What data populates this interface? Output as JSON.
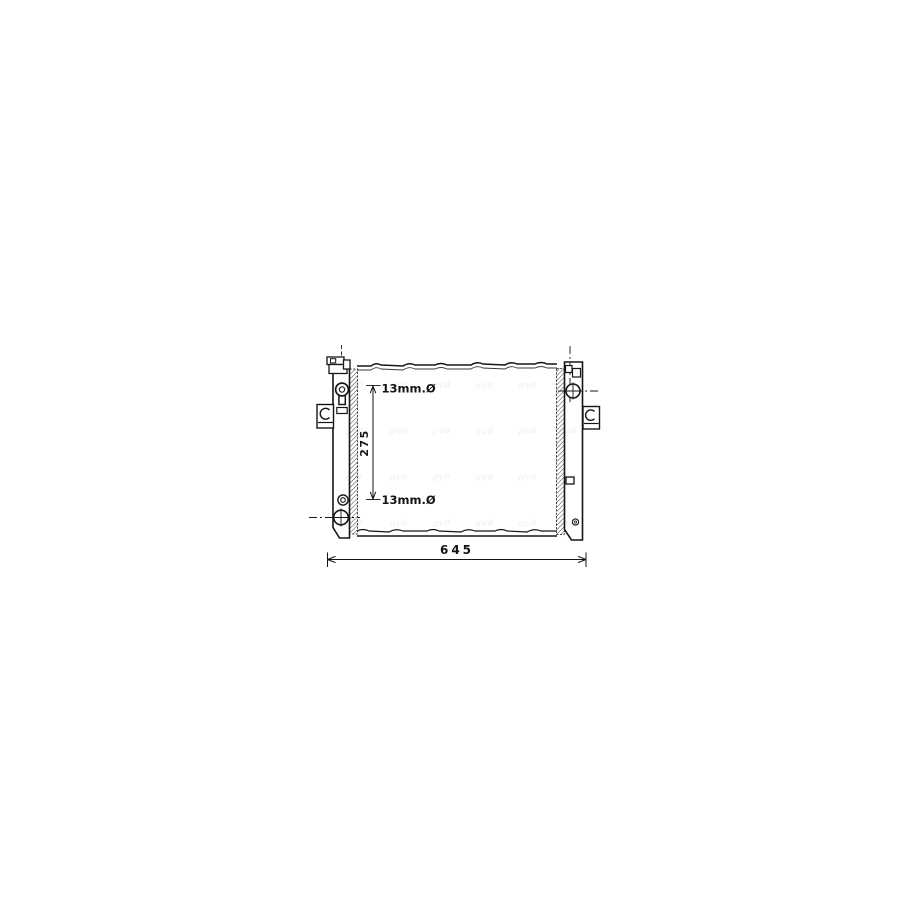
{
  "page": {
    "background": "#ffffff",
    "ink": "#161616"
  },
  "drawing": {
    "labels": {
      "top_port": "13mm.Ø",
      "bottom_port": "13mm.Ø",
      "core_height": "275",
      "overall_width": "645"
    },
    "watermark": {
      "text": "ava",
      "color": "rgba(30,30,30,0.055)",
      "font_size": 10,
      "columns_x": [
        345,
        389,
        432,
        475,
        518,
        558
      ],
      "rows_y": [
        380,
        426,
        472,
        518
      ]
    }
  }
}
